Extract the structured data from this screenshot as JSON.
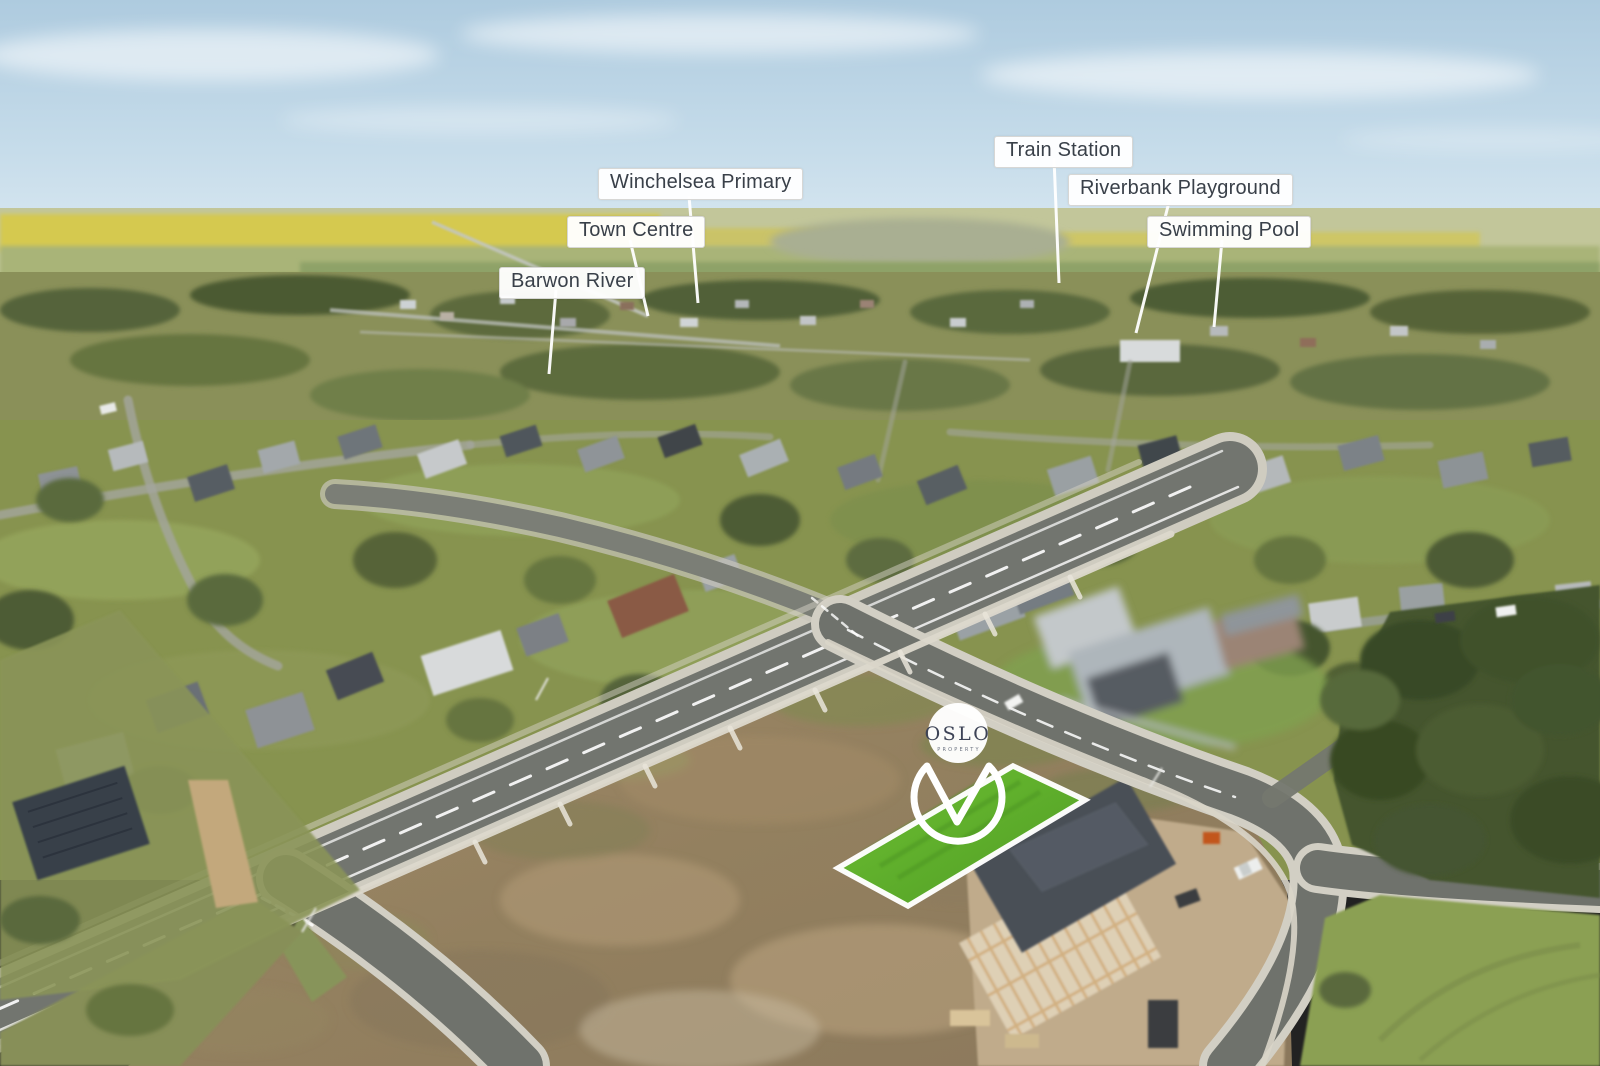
{
  "location_labels": [
    {
      "id": "barwon-river",
      "text": "Barwon River"
    },
    {
      "id": "town-centre",
      "text": "Town Centre"
    },
    {
      "id": "winchelsea-primary",
      "text": "Winchelsea Primary"
    },
    {
      "id": "train-station",
      "text": "Train Station"
    },
    {
      "id": "riverbank-playground",
      "text": "Riverbank Playground"
    },
    {
      "id": "swimming-pool",
      "text": "Swimming Pool"
    }
  ],
  "pin": {
    "brand": "OSLO",
    "subtext": "PROPERTY"
  },
  "colors": {
    "label_text": "#394049",
    "label_background": "#ffffff",
    "leader_line": "#ffffff",
    "lot_highlight_green": "#5fae2c",
    "lot_border": "#ffffff",
    "pin_outline": "#ffffff",
    "pin_text": "#3d4356",
    "sky_blue": "#b9d3e4",
    "canola_yellow": "#d5c94f",
    "road_asphalt": "#6f726c",
    "dirt_brown": "#9b8266"
  }
}
